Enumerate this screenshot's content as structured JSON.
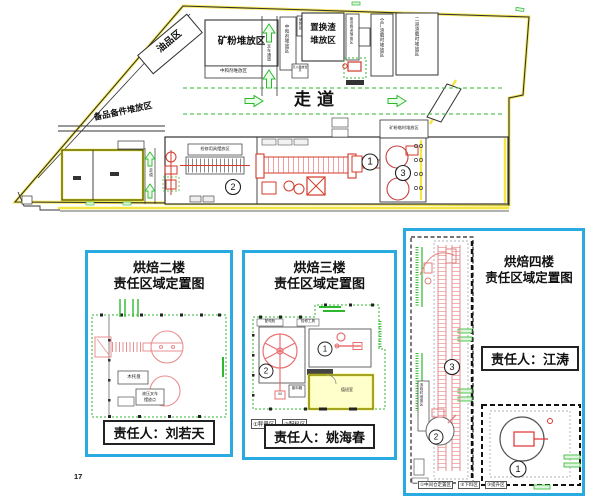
{
  "page": {
    "number": "17"
  },
  "main_plan": {
    "labels": {
      "oil_area": "油品区",
      "mineral_powder": "矿粉堆放区",
      "neutralizer_row": "中和剂堆放区",
      "forklift_lane": "叉车通道",
      "neutralizer_col": "中和剂堆放区",
      "storage_small": "储物区",
      "slag_line1": "置换渣",
      "slag_line2": "堆放区",
      "waste_col": "废旧物资堆放区",
      "plant_slag_col": "全厂渣临时堆放区",
      "second_slag_col": "二道渣临时堆放区",
      "spare_parts": "备品备件堆放区",
      "walkway": "走道",
      "walkway_small": "走道",
      "maintenance_box": "检修用具摆放区",
      "mineral_temp": "矿粉临时堆放区",
      "extinguisher": "灭火器放置点"
    },
    "markers": {
      "m1": "1",
      "m2": "2",
      "m3": "3"
    }
  },
  "panels": [
    {
      "title_line1": "烘焙二楼",
      "title_line2": "责任区域定置图",
      "owner": "责任人：刘若天",
      "labels": {
        "pallet": "木托盘",
        "forklift_line1": "液压叉车",
        "forklift_line2": "摆放点"
      }
    },
    {
      "title_line1": "烘焙三楼",
      "title_line2": "责任区域定置图",
      "owner": "责任人：姚海春",
      "labels": {
        "box_left": "配电柜",
        "box_right": "检修工具",
        "room": "值班室",
        "bin": "废料箱",
        "pump": "M"
      },
      "legend": [
        "①秤量区",
        "②配料区"
      ],
      "markers": {
        "m1": "1",
        "m2": "2"
      }
    },
    {
      "title_line1": "烘焙四楼",
      "title_line2": "责任区域定置图",
      "owner": "责任人：江涛",
      "labels": {
        "side_col": "渣临时堆放区"
      },
      "legend": [
        "①中间仓定置区",
        "②下料区",
        "③提升区"
      ],
      "markers": {
        "m1": "1",
        "m2": "2",
        "m3": "3"
      }
    }
  ]
}
